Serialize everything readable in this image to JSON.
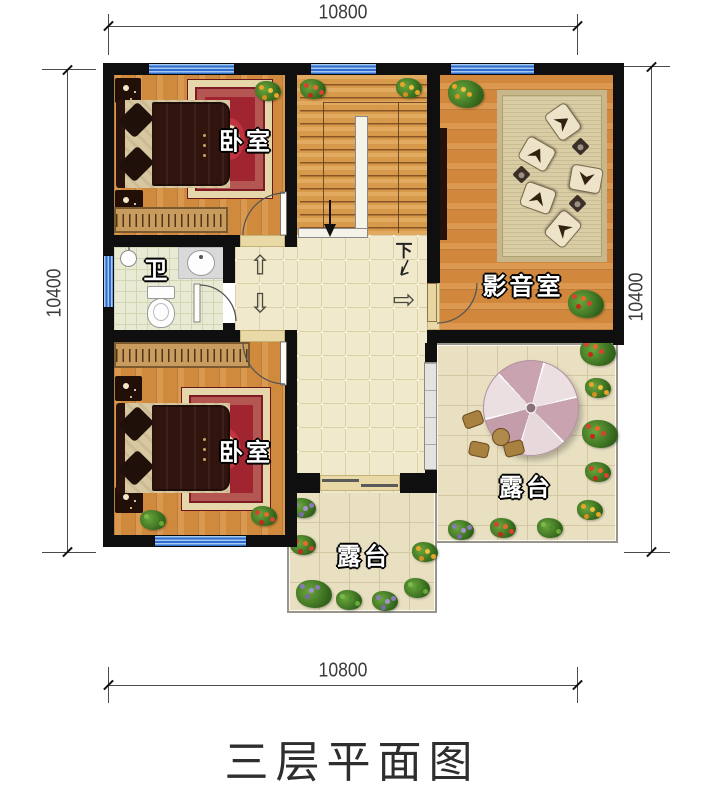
{
  "title": "三层平面图",
  "dimensions": {
    "top": "10800",
    "bottom": "10800",
    "left": "10400",
    "right": "10400"
  },
  "rooms": {
    "bedroom_top": "卧室",
    "bedroom_bottom": "卧室",
    "bathroom": "卫",
    "media_room": "影音室",
    "terrace_right": "露台",
    "terrace_bottom": "露台"
  },
  "stairs": {
    "down_label": "下"
  },
  "arrows": {
    "up": "⇧",
    "down": "⇩",
    "right": "⇨"
  },
  "colors": {
    "wall": "#0f0f0f",
    "window": "#2f6bca",
    "wood": "#d08a3e",
    "hall_tile": "#f0e9cc",
    "terrace_tile": "#e9e0c2",
    "carpet": "#a02531"
  }
}
